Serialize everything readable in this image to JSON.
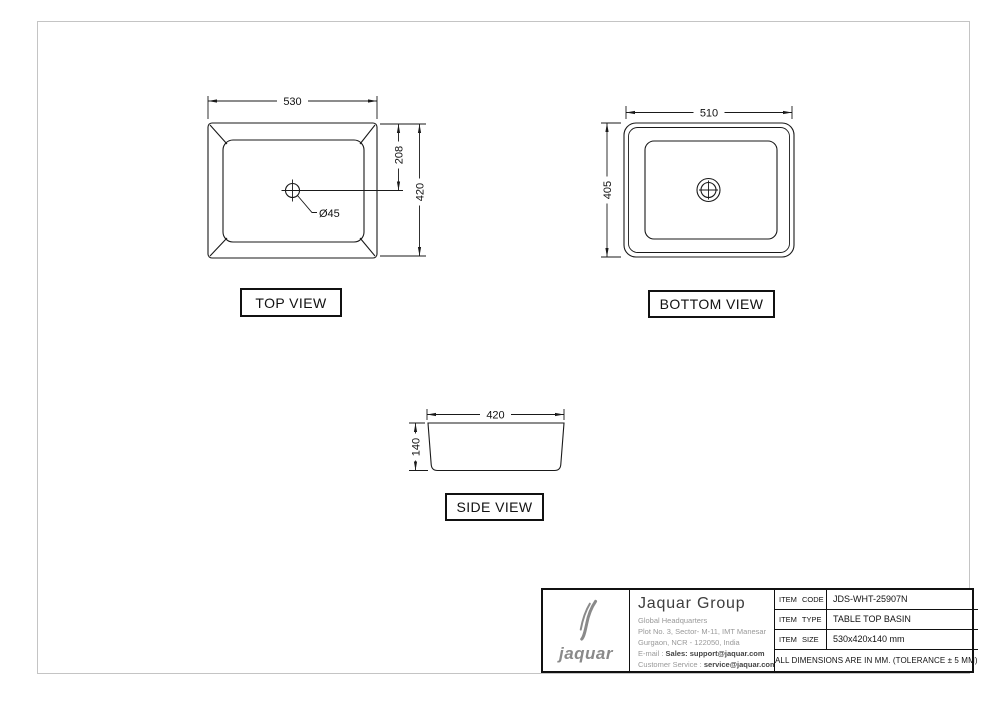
{
  "views": {
    "top": {
      "label": "TOP VIEW",
      "width_dim": "530",
      "hole_offset_dim": "208",
      "height_dim": "420",
      "drain_dim": "Ø45"
    },
    "bottom": {
      "label": "BOTTOM VIEW",
      "width_dim": "510",
      "height_dim": "405"
    },
    "side": {
      "label": "SIDE VIEW",
      "width_dim": "420",
      "height_dim": "140"
    }
  },
  "title_block": {
    "logo": {
      "wordmark": "jaquar",
      "icon": "jaquar-double-j-swoosh"
    },
    "company_name": "Jaquar Group",
    "address_line1": "Global Headquarters",
    "address_line2": "Plot No. 3, Sector- M-11, IMT Manesar",
    "address_line3": "Gurgaon, NCR - 122050, India",
    "email_label": "E-mail : ",
    "email_value": "Sales: support@jaquar.com",
    "service_label": "Customer Service : ",
    "service_value": "service@jaquar.com",
    "item_code_label": "ITEM CODE",
    "item_code_value": "JDS-WHT-25907N",
    "item_type_label": "ITEM TYPE",
    "item_type_value": "TABLE TOP BASIN",
    "item_size_label": "ITEM SIZE",
    "item_size_value": "530x420x140 mm",
    "tolerance_note": "ALL DIMENSIONS ARE IN MM. (TOLERANCE ± 5 MM)"
  },
  "colors": {
    "line": "#1a1a1a",
    "logo_gray": "#8a8a8a",
    "address_gray": "#999999",
    "page_border": "#c4c4c4"
  }
}
